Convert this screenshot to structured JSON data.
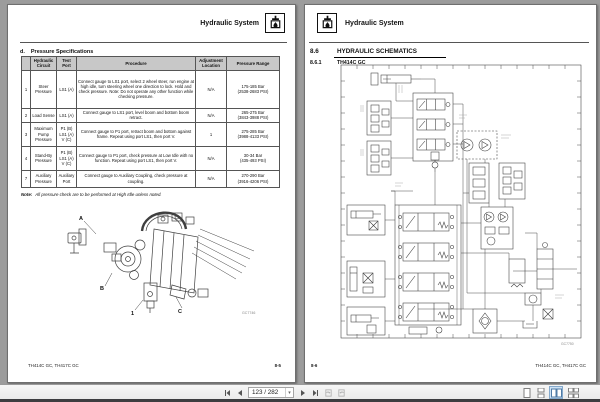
{
  "toolbar": {
    "page_value": "123 / 282",
    "caret": "▾"
  },
  "left_page": {
    "header_title": "Hydraulic System",
    "section_prefix": "d.",
    "section_title": "Pressure Specifications",
    "table": {
      "headers": [
        "",
        "Hydraulic\nCircuit",
        "Test Port",
        "Procedure",
        "Adjustment\nLocation",
        "Pressure Range"
      ],
      "rows": [
        {
          "num": "1",
          "circuit": "Steer Pressure",
          "test_port": "LS1 (A)",
          "procedure": "Connect gauge to LS1 port, select 2 wheel steer, run engine at high idle, turn steering wheel one direction to lock. Hold and check pressure. Note: Do not operate any other function while checking pressure.",
          "adjustment": "N/A",
          "range": "175-185 Bar\n(2538-2683 PSI)"
        },
        {
          "num": "2",
          "circuit": "Load Sense",
          "test_port": "LS1 (A)",
          "procedure": "Connect gauge to LS1 port, level boom and bottom boom retract.",
          "adjustment": "N/A",
          "range": "265-275 Bar\n(3843-3988 PSI)"
        },
        {
          "num": "3",
          "circuit": "Maximum Pump Pressure",
          "test_port": "P1 (B)\nLS1 (A)\nV (C)",
          "procedure": "Connect gauge to P1 port, retract boom and bottom against frame. Repeat using port LS1, then port V.",
          "adjustment": "1",
          "range": "275-285 Bar\n(3988-4133 PSI)"
        },
        {
          "num": "4",
          "circuit": "Stand-By Pressure",
          "test_port": "P1 (B)\nLS1 (A)\nV (C)",
          "procedure": "Connect gauge to P1 port, check pressure at Low Idle with no function. Repeat using port LS1, then port V.",
          "adjustment": "N/A",
          "range": "30-34 Bar\n(435-493 PSI)"
        },
        {
          "num": "7",
          "circuit": "Auxiliary Pressure",
          "test_port": "Auxiliary Port",
          "procedure": "Connect gauge to Auxiliary Coupling, check pressure at coupling.",
          "adjustment": "N/A",
          "range": "270-290 Bar\n(3916-4206 PSI)"
        }
      ]
    },
    "note_label": "Note:",
    "note_text": "All pressure check are to be performed at High Idle unless noted.",
    "figure": {
      "label_a": "A",
      "label_b": "B",
      "label_c": "C",
      "label_1": "1",
      "code": "GC7746"
    },
    "footer_left": "TH414C GC, TH417C GC",
    "footer_right": "8-5"
  },
  "right_page": {
    "header_title": "Hydraulic System",
    "section_number": "8.6",
    "section_title": "HYDRAULIC SCHEMATICS",
    "subsection_number": "8.6.1",
    "subsection_title": "TH414C GC",
    "figure_code": "GC7750",
    "footer_left": "8-6",
    "footer_right": "TH414C GC, TH417C GC"
  }
}
